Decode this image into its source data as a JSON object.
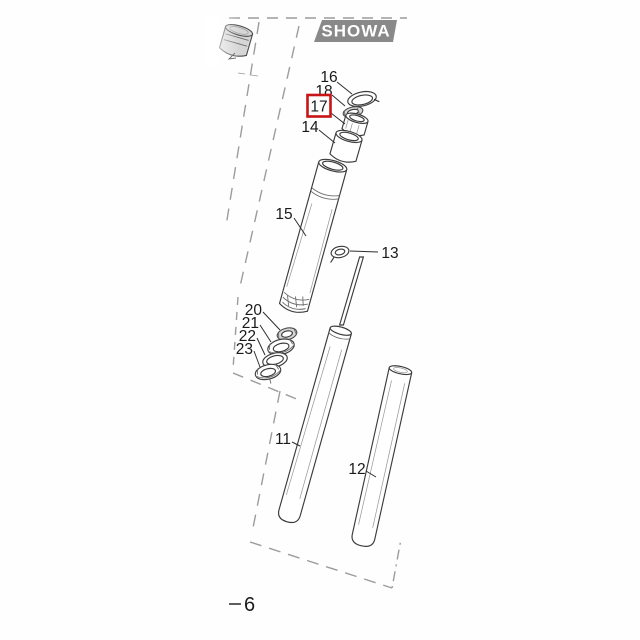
{
  "badge": {
    "label": "SHOWA"
  },
  "labels": {
    "n16": "16",
    "n18": "18",
    "n14": "14",
    "n15": "15",
    "n13": "13",
    "n20": "20",
    "n21": "21",
    "n22": "22",
    "n23": "23",
    "n11": "11",
    "n12": "12"
  },
  "highlight": {
    "part_number": "17",
    "color": "#c81414"
  },
  "assembly_ref": {
    "number": "6"
  },
  "colors": {
    "background": "#ffffff",
    "line": "#3b3b3b",
    "dashed_border": "#9c9c9c",
    "badge_bg": "#898989",
    "badge_text": "#ffffff",
    "highlight_box": "#c81414",
    "label_text": "#1a1a1a"
  }
}
